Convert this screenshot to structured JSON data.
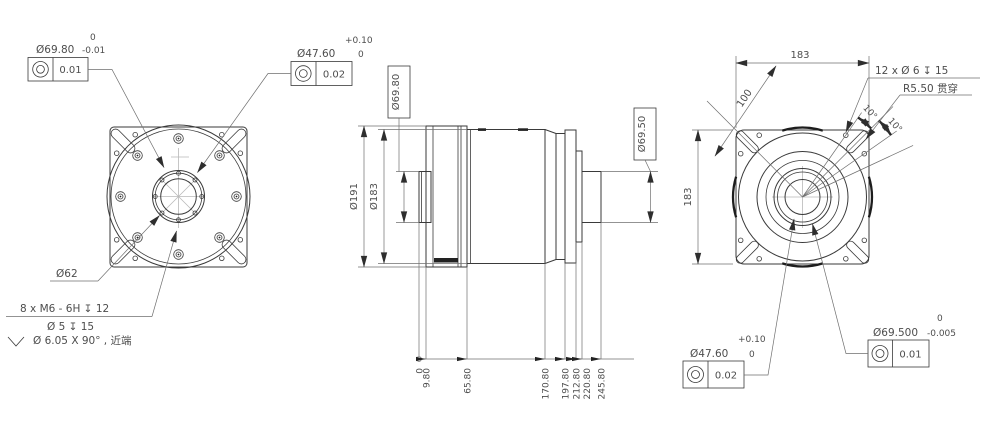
{
  "drawing": {
    "front_view": {
      "fcf_pilot": {
        "dim": "Ø69.80",
        "tol_upper": "0",
        "tol_lower": "-0.01",
        "value": "0.01"
      },
      "fcf_bore": {
        "dim": "Ø47.60",
        "tol_upper": "+0.10",
        "tol_lower": "0",
        "value": "0.02"
      },
      "bolt_circle": "Ø62",
      "thread_note": "8 x M6 - 6H ↧ 12",
      "drill_note": "Ø 5 ↧ 15",
      "csink_symbol": "⌵",
      "csink_note": "Ø 6.05 X 90° , 近端"
    },
    "side_view": {
      "front_pilot": "Ø69.80",
      "outer_dia": "Ø191",
      "body_dia": "Ø183",
      "rear_pilot": "Ø69.50",
      "ordinates": [
        "0",
        "9.80",
        "65.80",
        "170.80",
        "197.80",
        "212.80",
        "220.80",
        "245.80"
      ]
    },
    "rear_view": {
      "width": "183",
      "height": "183",
      "diagonal": "100",
      "hole_note": "12 x Ø 6 ↧ 15",
      "slot_note": "R5.50 贯穿",
      "angle_a": "10°",
      "angle_b": "10°",
      "fcf_bore": {
        "dim": "Ø47.60",
        "tol_upper": "+0.10",
        "tol_lower": "0",
        "value": "0.02"
      },
      "fcf_pilot": {
        "dim": "Ø69.500",
        "tol_upper": "0",
        "tol_lower": "-0.005",
        "value": "0.01"
      }
    }
  }
}
